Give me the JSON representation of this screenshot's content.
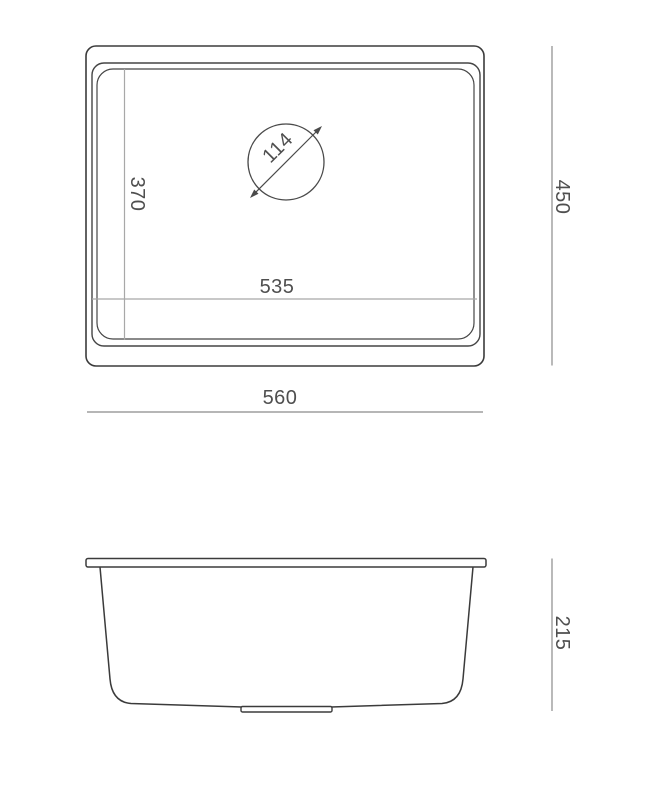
{
  "drawing": {
    "subject": "undermount-sink-dimension-drawing",
    "views": {
      "top_view": {
        "name": "top-view",
        "dimensions": {
          "overall_width": "560",
          "overall_depth": "450",
          "bowl_width": "535",
          "bowl_depth": "370",
          "drain_diameter": "114"
        }
      },
      "side_view": {
        "name": "side-view",
        "dimensions": {
          "overall_height": "215"
        }
      }
    },
    "colors": {
      "background": "#ffffff",
      "outline": "#3b3b3b",
      "rim_line": "#454545",
      "drain_circle": "#4a4a4a",
      "inner_dim_line": "#a8a8a8",
      "dim_line": "#8b8b8b",
      "dim_text": "#4f4f4f"
    }
  }
}
